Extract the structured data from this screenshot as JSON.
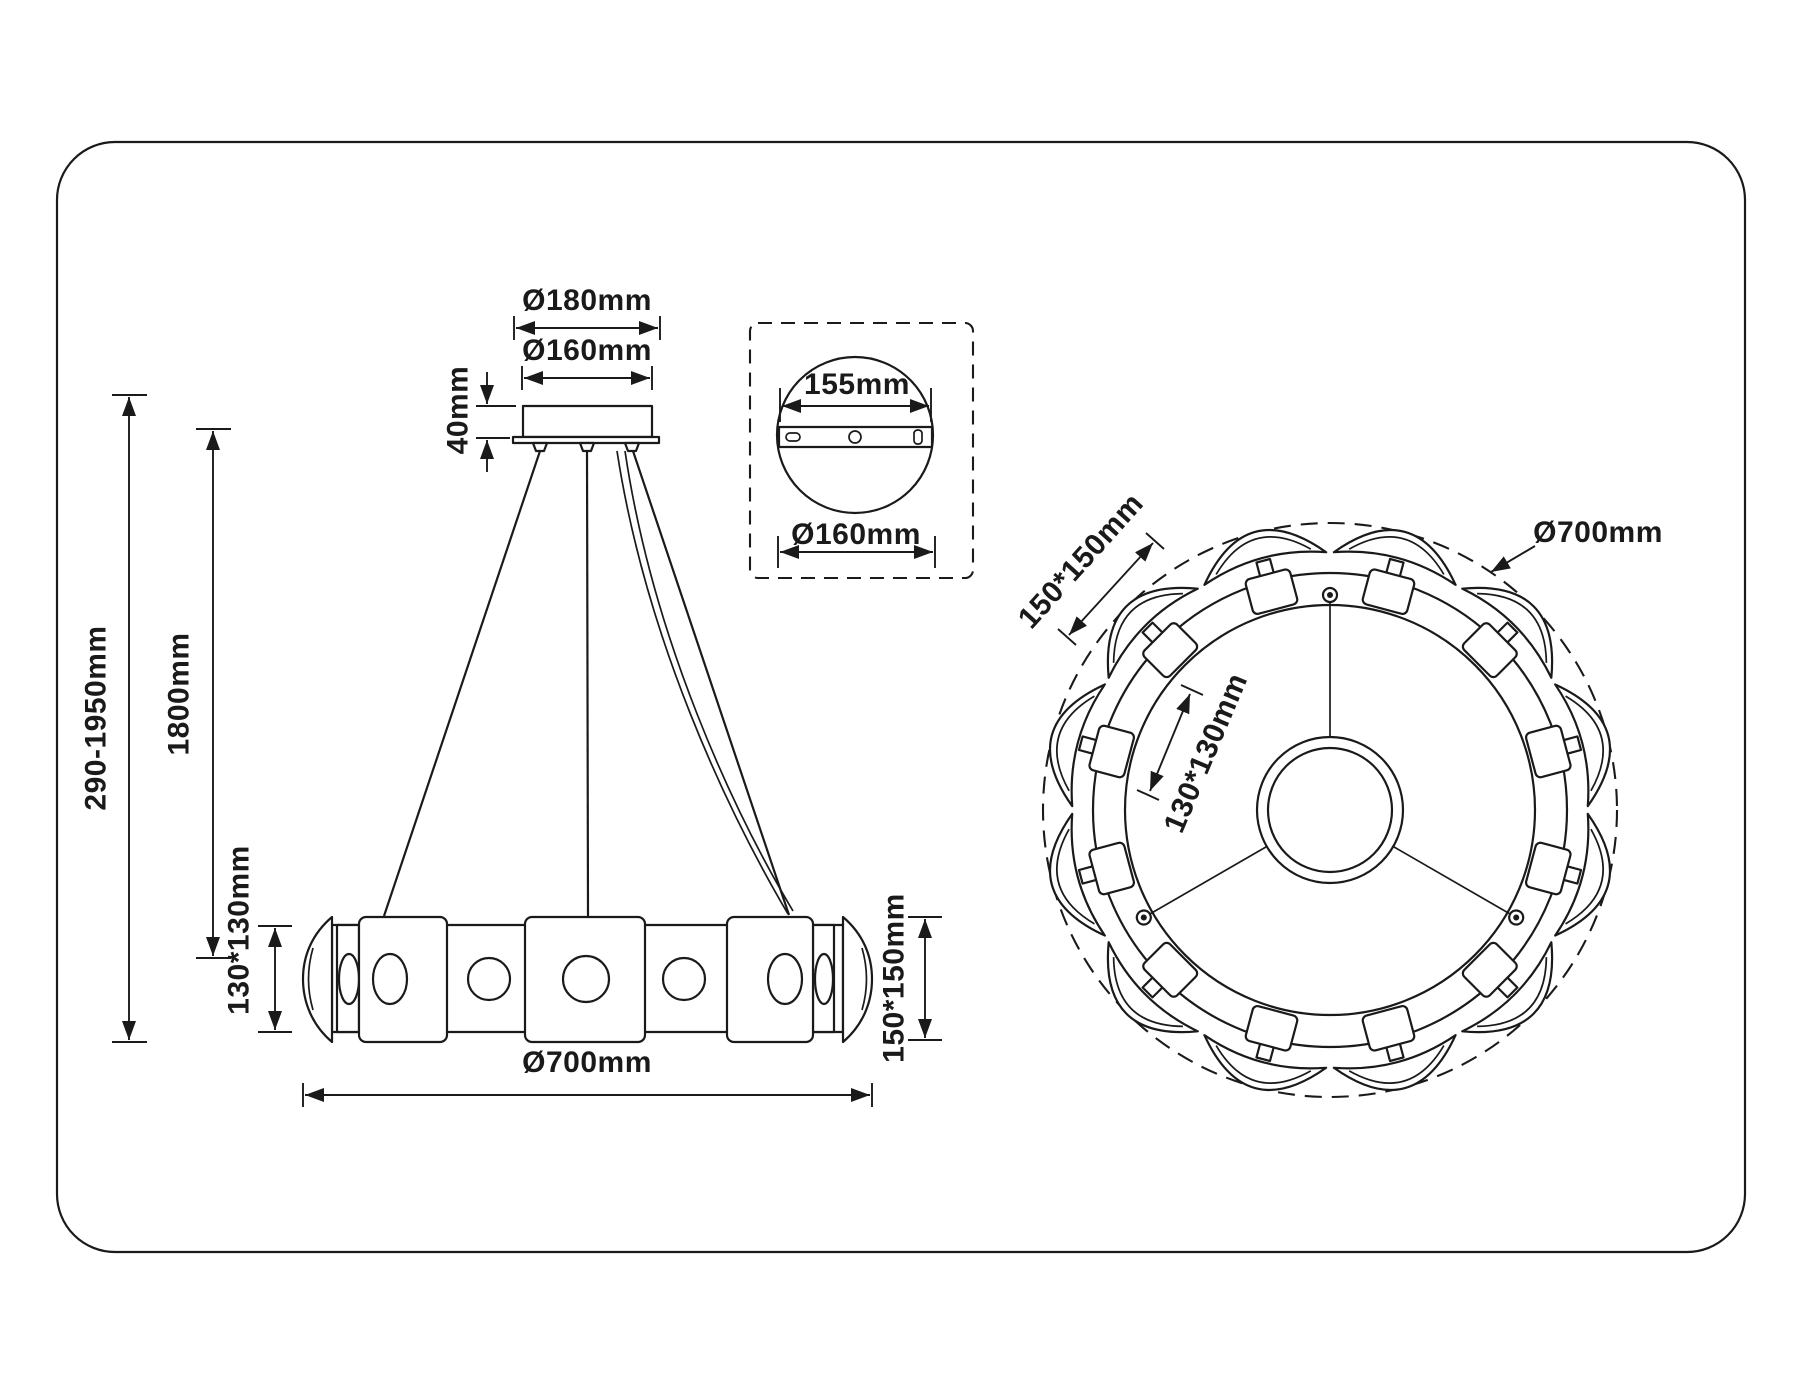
{
  "style": {
    "line_color": "#1a1a1a",
    "background": "#ffffff"
  },
  "views": {
    "front": {
      "labels": {
        "canopy_outer_diameter": "Ø180mm",
        "canopy_diameter": "Ø160mm",
        "canopy_height": "40mm",
        "overall_height_range": "290-1950mm",
        "suspension_length": "1800mm",
        "inner_lens_size": "130*130mm",
        "outer_lens_size": "150*150mm",
        "fixture_diameter": "Ø700mm"
      }
    },
    "canopy_detail": {
      "labels": {
        "mounting_plate_width": "155mm",
        "canopy_diameter": "Ø160mm"
      }
    },
    "top": {
      "labels": {
        "outer_lens_size": "150*150mm",
        "inner_lens_size": "130*130mm",
        "fixture_diameter": "Ø700mm"
      }
    }
  }
}
